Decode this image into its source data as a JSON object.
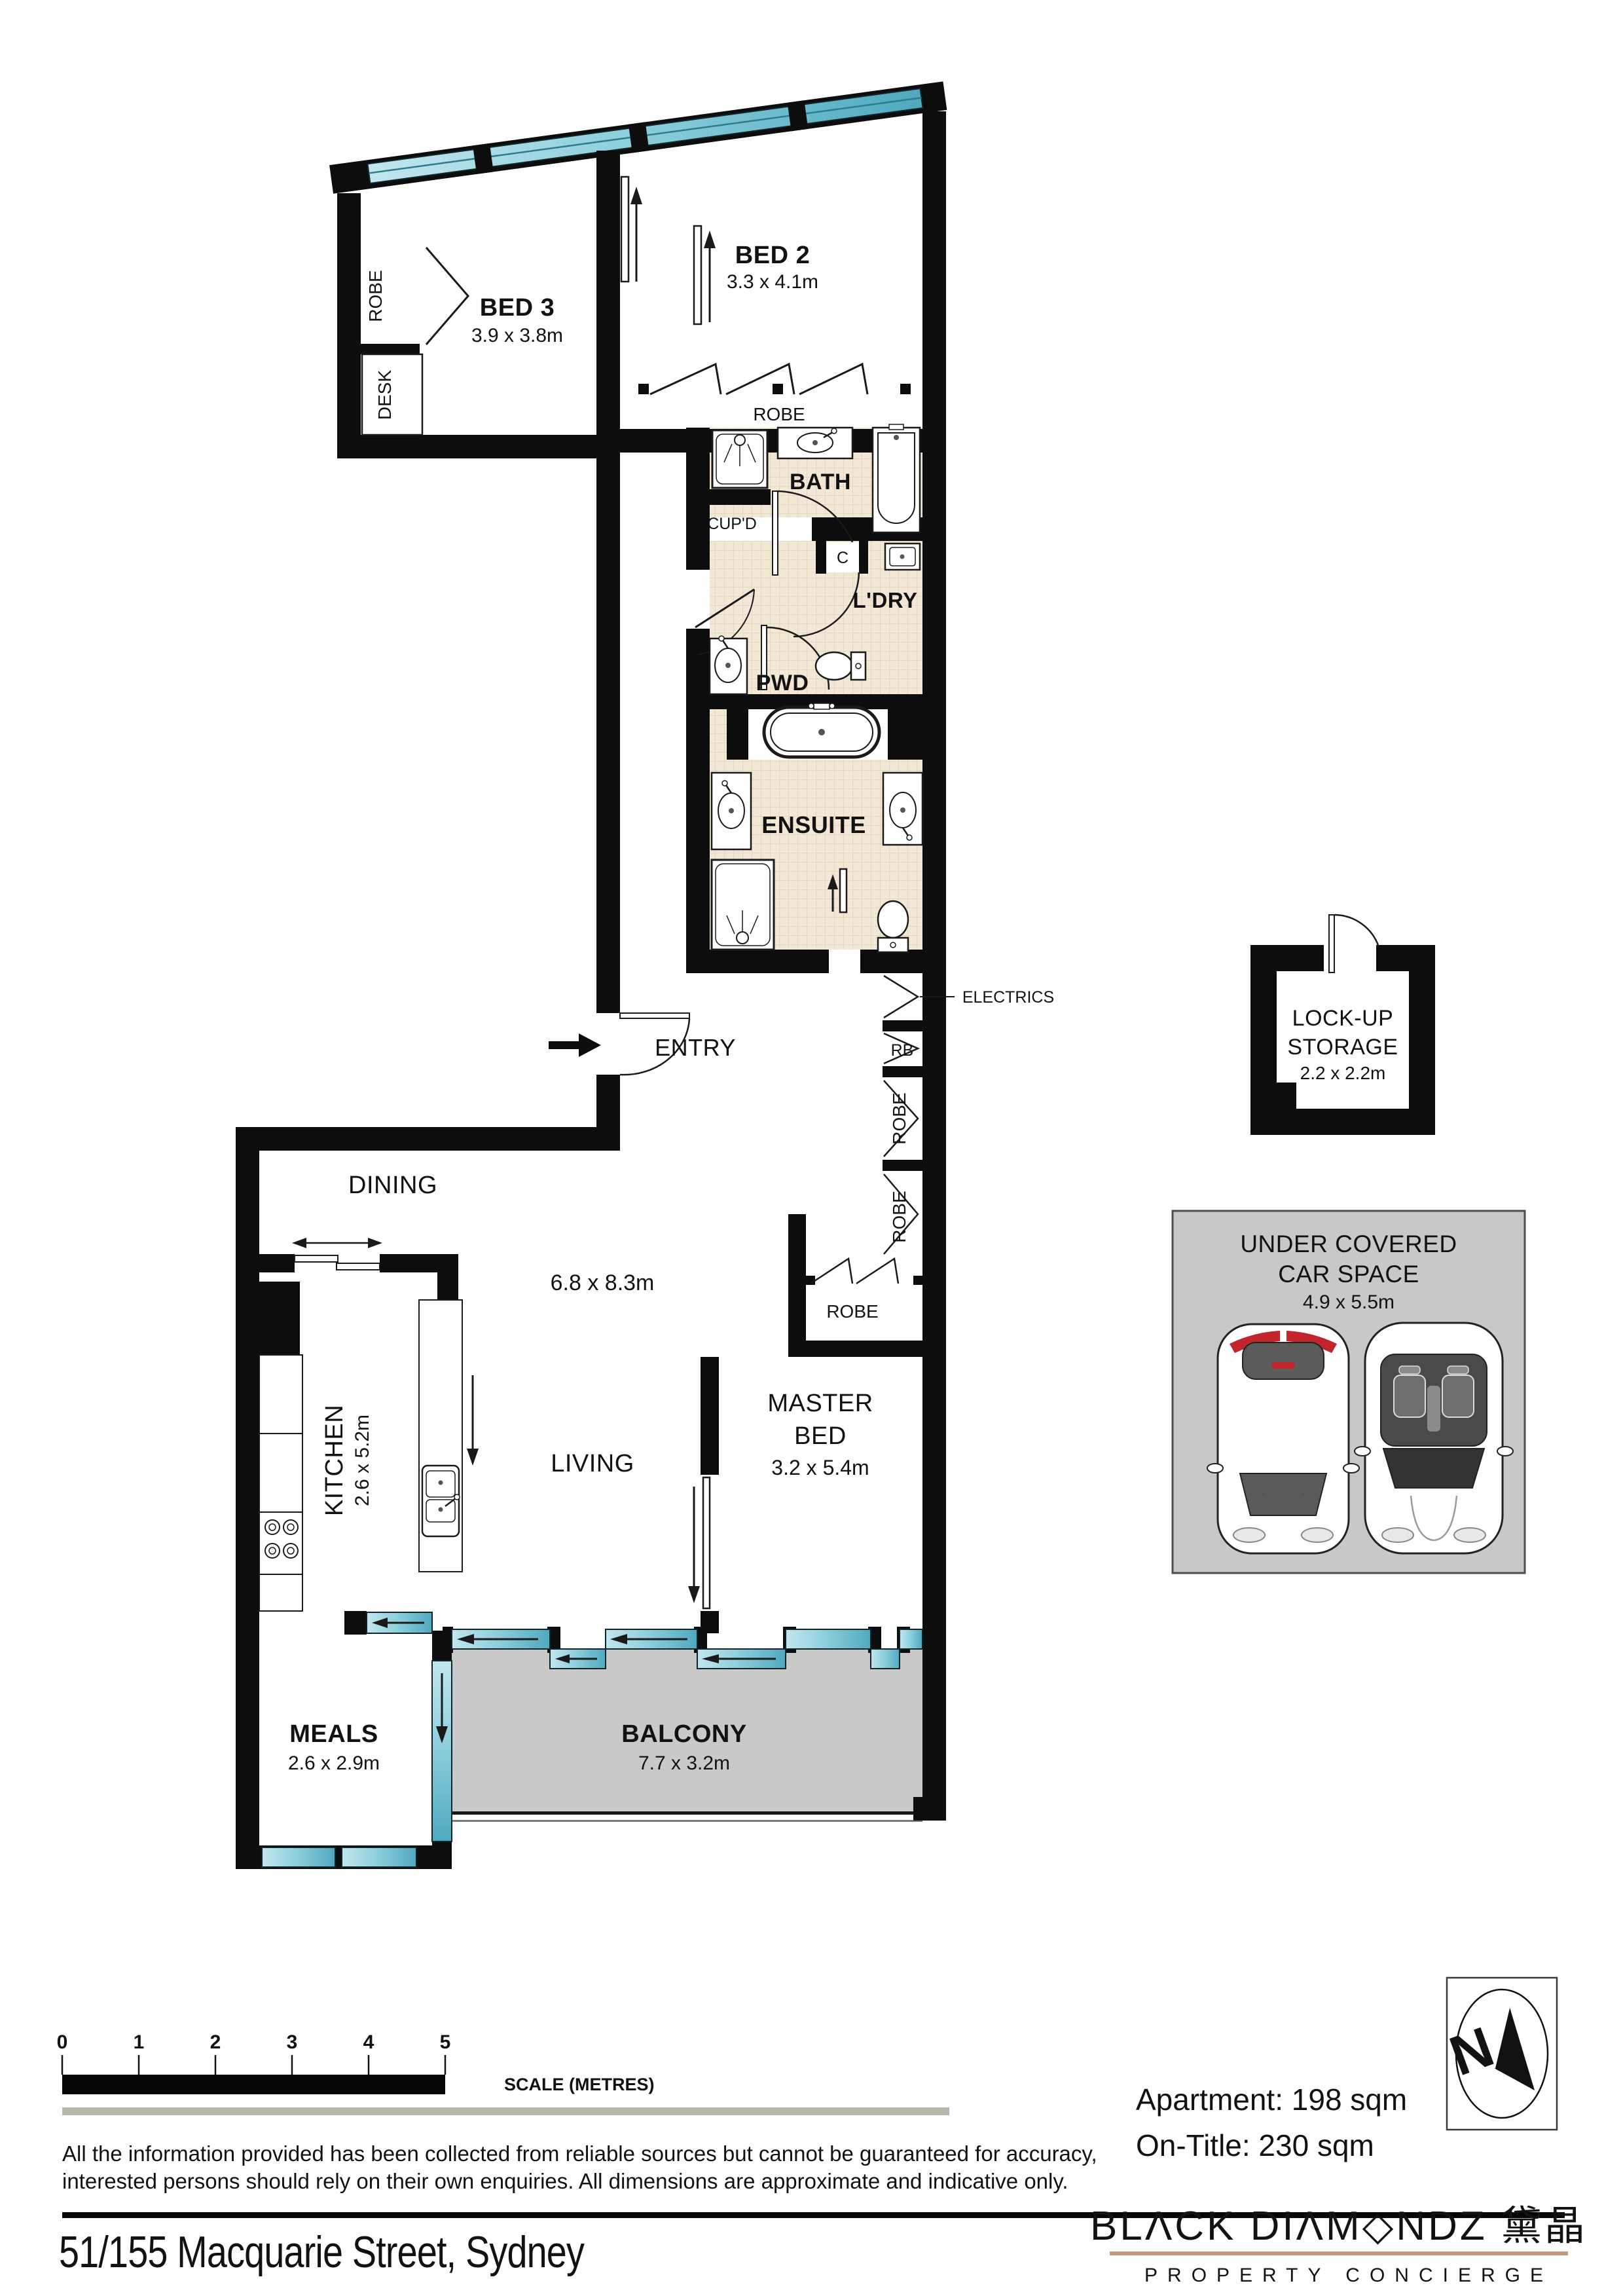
{
  "plan": {
    "rooms": {
      "bed3": {
        "name": "BED 3",
        "dims": "3.9 x 3.8m"
      },
      "bed2": {
        "name": "BED 2",
        "dims": "3.3 x 4.1m"
      },
      "robe": {
        "name": "ROBE"
      },
      "desk": {
        "name": "DESK"
      },
      "bath": {
        "name": "BATH"
      },
      "cupd": {
        "name": "CUP'D"
      },
      "c": {
        "name": "C"
      },
      "ldry": {
        "name": "L'DRY"
      },
      "pwd": {
        "name": "PWD"
      },
      "ensuite": {
        "name": "ENSUITE"
      },
      "entry": {
        "name": "ENTRY"
      },
      "electrics": {
        "name": "ELECTRICS"
      },
      "rb": {
        "name": "RB"
      },
      "dining": {
        "name": "DINING"
      },
      "living": {
        "name": "LIVING",
        "dims": "6.8 x 8.3m"
      },
      "kitchen": {
        "name": "KITCHEN",
        "dims": "2.6 x 5.2m"
      },
      "master": {
        "line1": "MASTER",
        "line2": "BED",
        "dims": "3.2 x 5.4m"
      },
      "meals": {
        "name": "MEALS",
        "dims": "2.6 x 2.9m"
      },
      "balcony": {
        "name": "BALCONY",
        "dims": "7.7 x 3.2m"
      },
      "storage": {
        "line1": "LOCK-UP",
        "line2": "STORAGE",
        "dims": "2.2 x 2.2m"
      },
      "carspace": {
        "line1": "UNDER COVERED",
        "line2": "CAR SPACE",
        "dims": "4.9 x 5.5m"
      }
    }
  },
  "footer": {
    "scale": {
      "ticks": [
        "0",
        "1",
        "2",
        "3",
        "4",
        "5"
      ],
      "label": "SCALE (METRES)"
    },
    "disclaimer_line1": "All the information provided has been collected from reliable sources but cannot be guaranteed for accuracy,",
    "disclaimer_line2": "interested persons should rely on their own enquiries. All dimensions are approximate and indicative only.",
    "address": "51/155 Macquarie Street, Sydney",
    "apartment_area": "Apartment: 198 sqm",
    "on_title_area": "On-Title: 230 sqm",
    "compass_letter": "N"
  },
  "brand": {
    "logo_text": "BLΛCK DIΛM◇NDZ 黛晶",
    "logo_sub": "PROPERTY CONCIERGE",
    "copper": "#c08b6e"
  },
  "colors": {
    "wall": "#0d0d0d",
    "window_teal": "#7cc6d8",
    "tile": "#f2e8d5",
    "balcony_gray": "#c9c9c9"
  }
}
